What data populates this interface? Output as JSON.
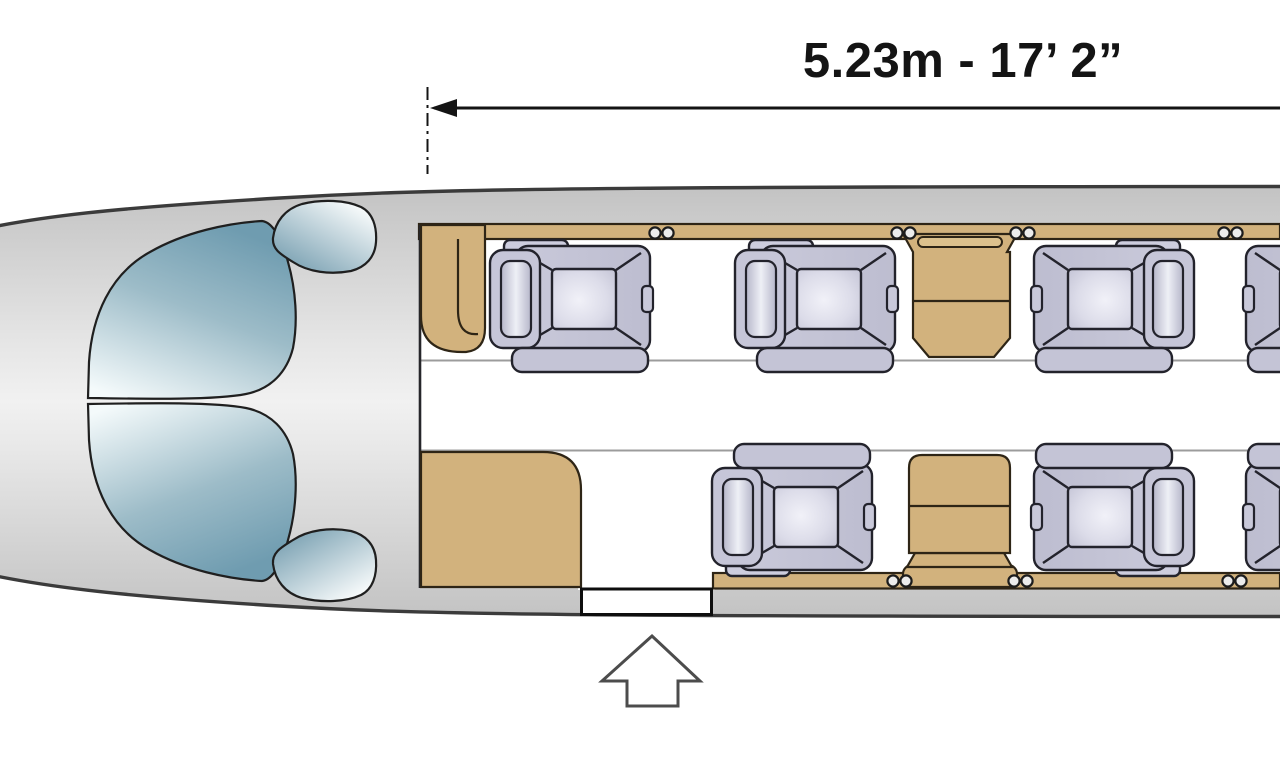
{
  "dimension": {
    "label": "5.23m - 17’ 2”",
    "meters": "5.23m",
    "feet_inches": "17’ 2”"
  },
  "colors": {
    "ink": "#141414",
    "outline_ink": "#3b3b3b",
    "fuselage_gray": "#d2d2d2",
    "wood_tan": "#d2b27d",
    "wood_edge": "#2e2516",
    "seat_shell": "#c4c4d6",
    "seat_ink": "#23232c",
    "glass_teal": "#7da3b4",
    "aisle_line": "#9c9c9c",
    "arrow_ink": "#4c4c4c"
  },
  "cabin": {
    "passenger_seats_visible": 7,
    "seats": [
      {
        "id": "seat-top-1",
        "row": "top",
        "facing": "right",
        "x": 490
      },
      {
        "id": "seat-top-2",
        "row": "top",
        "facing": "right",
        "x": 735
      },
      {
        "id": "seat-top-3",
        "row": "top",
        "facing": "left",
        "x": 1031
      },
      {
        "id": "seat-top-4",
        "row": "top",
        "facing": "left",
        "x": 1243
      },
      {
        "id": "seat-bottom-1",
        "row": "bottom",
        "facing": "right",
        "x": 712
      },
      {
        "id": "seat-bottom-2",
        "row": "bottom",
        "facing": "left",
        "x": 1031
      },
      {
        "id": "seat-bottom-3",
        "row": "bottom",
        "facing": "left",
        "x": 1243
      }
    ],
    "rail_fittings": {
      "top_x": [
        649,
        891,
        1010,
        1218
      ],
      "bottom_x": [
        887,
        1008,
        1222
      ]
    },
    "furniture": [
      {
        "name": "forward-partition",
        "side": "top",
        "x": 421
      },
      {
        "name": "sidewall-cabinet",
        "side": "top",
        "x": 903
      },
      {
        "name": "galley-cabinet",
        "side": "bottom",
        "x": 421
      },
      {
        "name": "conference-table",
        "side": "bottom",
        "x": 903
      }
    ],
    "door": {
      "name": "entry-door",
      "x": 581
    }
  }
}
